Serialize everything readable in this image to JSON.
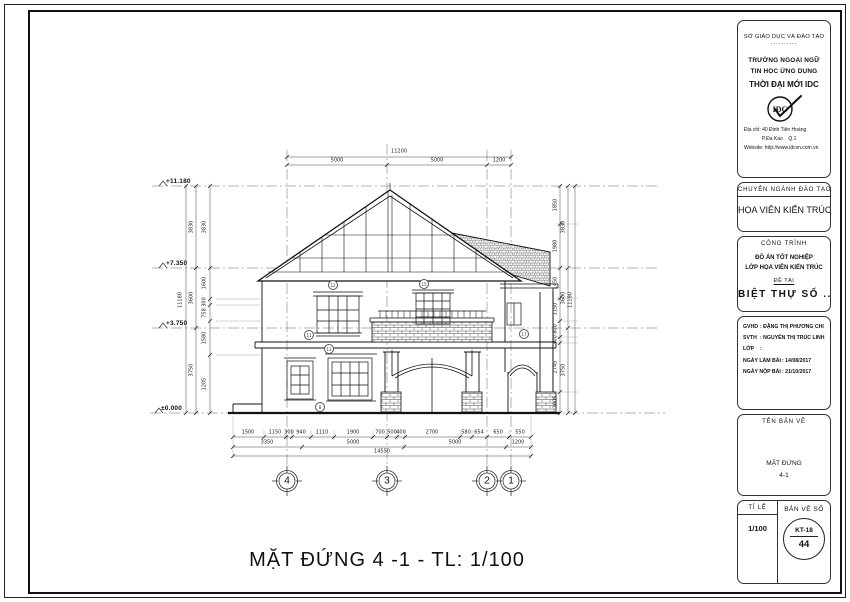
{
  "title_block": {
    "department": "SỞ GIÁO DỤC VÀ ĐÀO TẠO",
    "department_dashes": "..........",
    "school_line1": "TRƯỜNG NGOẠI NGỮ",
    "school_line2": "TIN HỌC ỨNG DỤNG",
    "school_line3": "THỜI ĐẠI MỚI IDC",
    "logo_text": "IDC",
    "address_label": "Địa chỉ",
    "address_value": ": 40 Đinh Tiên Hoàng",
    "address_line2": "             P.Đa Kao    Q.1",
    "website_label": "Website",
    "website_value": ": http://www.idcvn.com.vn",
    "major_header": "CHUYÊN NGÀNH ĐÀO TẠO",
    "major": "HỌA VIÊN KIẾN TRÚC",
    "project_header": "CÔNG TRÌNH",
    "project_line1": "ĐỒ ÁN TỐT NGHIỆP",
    "project_line2": "LỚP HỌA VIÊN KIẾN TRÚC",
    "topic_label": "ĐỀ TÀI",
    "topic": "BIỆT THỰ SỐ ...",
    "info_rows": [
      {
        "label": "GVHD",
        "value": ": ĐẶNG THỊ PHƯƠNG CHI"
      },
      {
        "label": "SVTH",
        "value": ": NGUYỄN THỊ TRÚC LINH"
      },
      {
        "label": "LỚP",
        "value": ":"
      },
      {
        "label": "NGÀY LÀM BÀI",
        "value": ": 14/08/2017"
      },
      {
        "label": "NGÀY NỘP BÀI",
        "value": ": 21/10/2017"
      }
    ],
    "drawing_name_header": "TÊN BẢN VẼ",
    "drawing_name_line1": "MẶT ĐỨNG",
    "drawing_name_line2": "4-1",
    "scale_label": "TỈ LỆ",
    "scale": "1/100",
    "sheet_label": "BẢN VẼ SỐ",
    "sheet_code": "KT-18",
    "sheet_number": "44"
  },
  "drawing": {
    "caption": "MẶT ĐỨNG 4 -1 - TL: 1/100",
    "levels": [
      "+11.180",
      "+7.350",
      "+3.750",
      "±0.000"
    ],
    "grid_bubbles": [
      "4",
      "3",
      "2",
      "1"
    ],
    "part_tags": [
      "12",
      "15",
      "11",
      "13",
      "17",
      "8"
    ],
    "dims": {
      "top": {
        "total": "11200",
        "segments": [
          "5000",
          "5000",
          "1200"
        ]
      },
      "bottom": {
        "row1": [
          "1500",
          "1150",
          "300",
          "940",
          "1110",
          "1900",
          "700",
          "500",
          "400",
          "2700",
          "580",
          "654",
          "650",
          "550"
        ],
        "row2": [
          "3350",
          "5000",
          "5000",
          "1200"
        ],
        "total": "14550"
      },
      "left": {
        "total": "11180",
        "mid": [
          "3830",
          "3600",
          "3750"
        ],
        "inner": [
          "3830",
          "1600",
          "300",
          "758",
          "1580",
          "1205"
        ]
      },
      "right": {
        "total": "11180",
        "mid": [
          "3830",
          "3600",
          "3750"
        ],
        "inner": [
          "1850",
          "1980",
          "1450",
          "1150",
          "800",
          "300",
          "2745",
          "1005"
        ]
      }
    }
  }
}
